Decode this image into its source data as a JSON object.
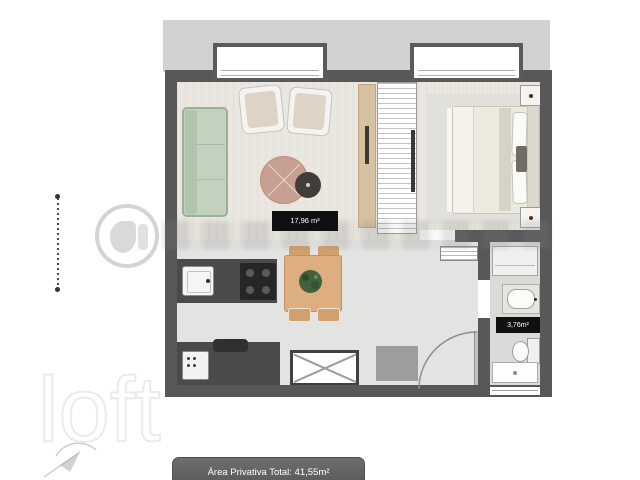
{
  "floorplan": {
    "living_area_label": "17,96 m²",
    "bathroom_area_label": "3,76m²",
    "footer_total_label": "Área Privativa Total: 41,55m²"
  },
  "watermark": {
    "brand": "loft"
  },
  "colors": {
    "wall": "#585858",
    "balcony_slab": "#d2d2d2",
    "living_floor": "#eae7e0",
    "kitchen_floor": "#e3e3e1",
    "bathroom_floor": "#dadad8",
    "sofa_green": "#c3d2be",
    "dining_table_wood": "#dcae80",
    "counter_dark": "#4a4a4a",
    "plant_green": "#41603c",
    "coffee_table_rose": "#c79f93",
    "area_label_bg": "#101010",
    "footer_bg": "#646464"
  }
}
